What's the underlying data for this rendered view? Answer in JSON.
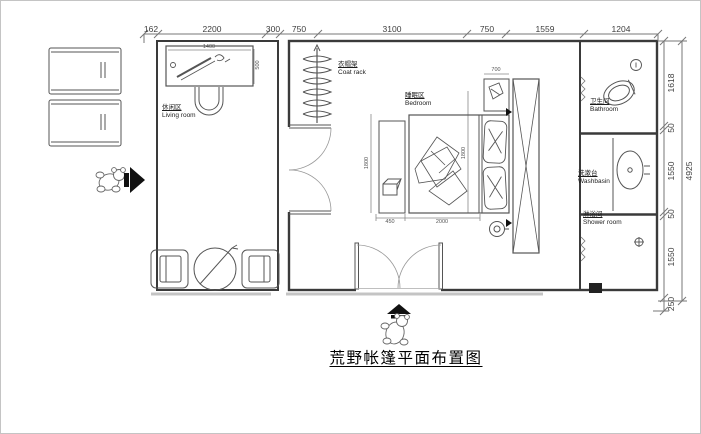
{
  "title": "荒野帐篷平面布置图",
  "rooms": {
    "living": {
      "cn": "休闲区",
      "en": "Living room"
    },
    "coatrack": {
      "cn": "衣帽架",
      "en": "Coat rack"
    },
    "bedroom": {
      "cn": "睡眠区",
      "en": "Bedroom"
    },
    "bathroom": {
      "cn": "卫生间",
      "en": "Bathroom"
    },
    "washbasin": {
      "cn": "洗漱台",
      "en": "Washbasin"
    },
    "shower": {
      "cn": "淋浴间",
      "en": "Shower room"
    }
  },
  "dims": {
    "top": [
      "162",
      "2200",
      "300",
      "750",
      "3100",
      "750",
      "1559",
      "1204"
    ],
    "right": [
      "1618",
      "50",
      "1550",
      "50",
      "1550",
      "250"
    ],
    "right_total": "4925",
    "interior": {
      "desk_width": "1400",
      "desk_depth": "500",
      "nightstand_width": "700",
      "bench_width": "450",
      "bed_length": "2000",
      "bed_width_left": "1800",
      "bed_width_right": "1800"
    }
  },
  "colors": {
    "line": "#4a4a4a",
    "wall": "#3a3a3a",
    "dim_line": "#777777",
    "arrow": "#111111"
  }
}
